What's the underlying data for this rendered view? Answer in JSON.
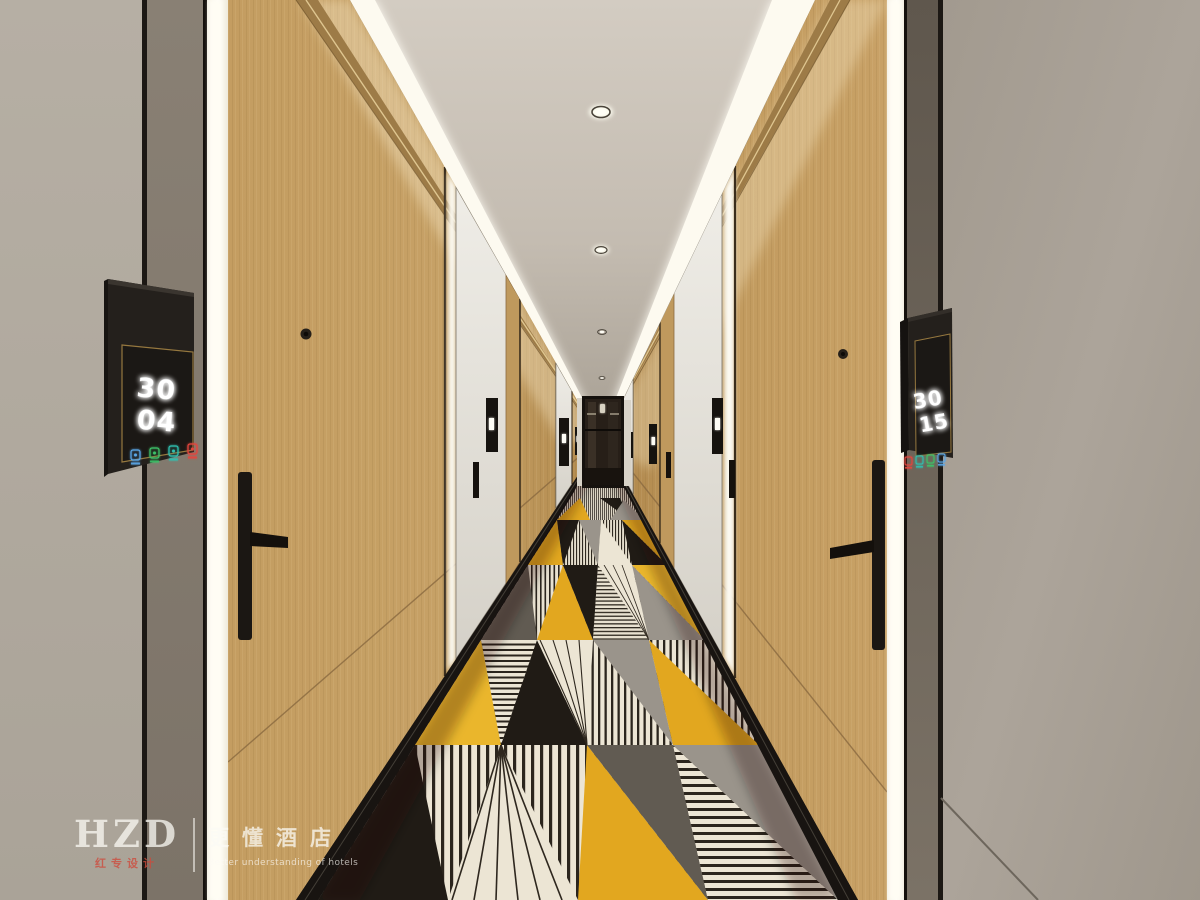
{
  "scene": {
    "name": "hotel-guestroom-corridor-rendering",
    "elements": "wood guest room doors, illuminated door frames, geometric carpet, lit ceiling coves"
  },
  "left_room_sign": {
    "number_top": "30",
    "number_bottom": "04",
    "indicators": [
      {
        "name": "doorbell",
        "color": "#5aa7e8"
      },
      {
        "name": "do-not-disturb",
        "color": "#3cc168"
      },
      {
        "name": "make-up-room",
        "color": "#2fc0b0"
      },
      {
        "name": "sos",
        "color": "#e4453c"
      }
    ]
  },
  "right_room_sign": {
    "number_top": "30",
    "number_bottom": "15",
    "indicators": [
      {
        "name": "sos",
        "color": "#e4453c"
      },
      {
        "name": "make-up-room",
        "color": "#2fc0b0"
      },
      {
        "name": "do-not-disturb",
        "color": "#3cc168"
      },
      {
        "name": "doorbell",
        "color": "#5aa7e8"
      }
    ]
  },
  "watermark": {
    "logo": "HZD",
    "logo_sub": "红专设计",
    "brand": "更懂酒店",
    "brand_sub": "Better understanding of hotels"
  },
  "palette": {
    "wood": "#c09a5e",
    "ceiling": "#cdc5ba",
    "near_wall_grey": "#b2aba0",
    "dark_panel": "#847b70",
    "cove_light": "#fdfaf0",
    "carpet_yellow": "#e2a71f",
    "carpet_black": "#201b15",
    "carpet_cream": "#ece5d4",
    "carpet_grey": "#9a948b",
    "skirting_black": "#181411"
  }
}
